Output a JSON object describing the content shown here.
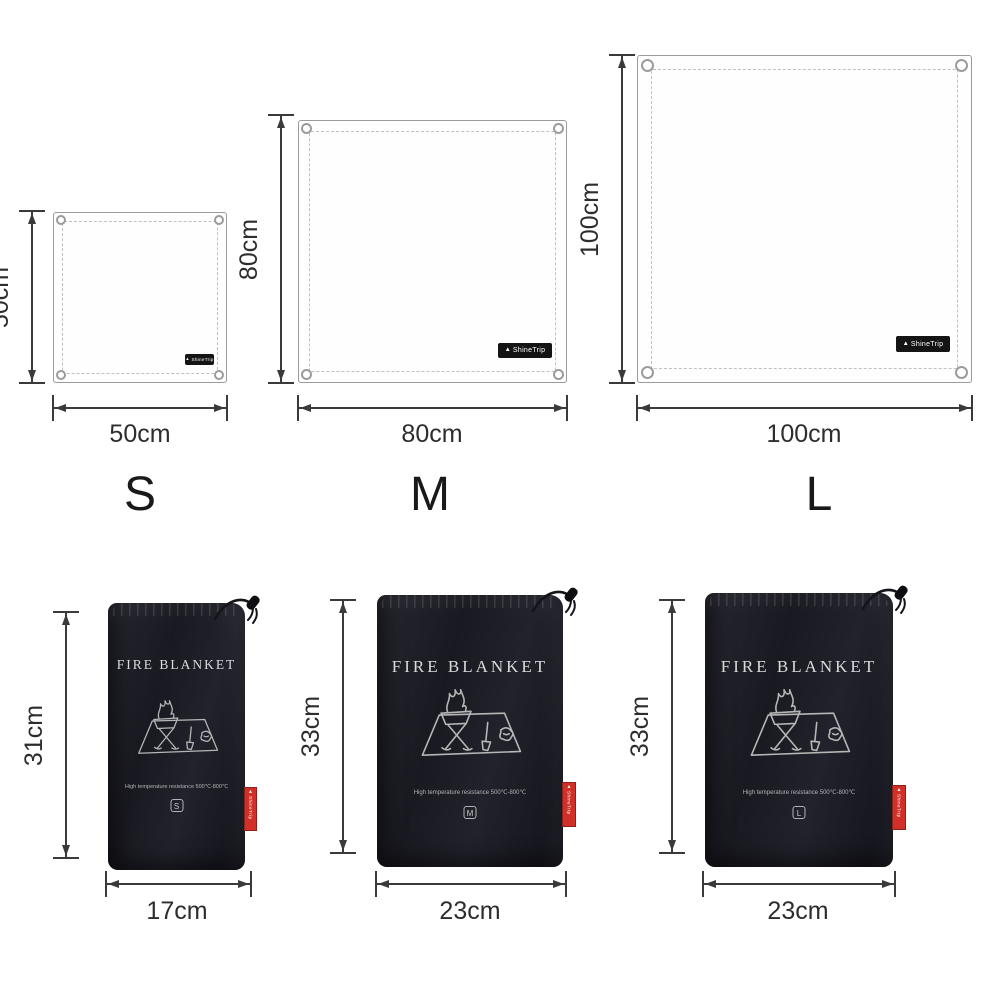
{
  "background_color": "#ffffff",
  "colors": {
    "dimension_lines": "#3a3a3a",
    "blanket_outline": "#9b9b9b",
    "bag_fabric": "#1a1a22",
    "brand_label_bg": "#141414",
    "red_tag": "#d03028"
  },
  "brand": {
    "name": "ShineTrip"
  },
  "blankets": [
    {
      "size_letter": "S",
      "height_label": "50cm",
      "width_label": "50cm"
    },
    {
      "size_letter": "M",
      "height_label": "80cm",
      "width_label": "80cm"
    },
    {
      "size_letter": "L",
      "height_label": "100cm",
      "width_label": "100cm"
    }
  ],
  "bags": [
    {
      "title": "FIRE BLANKET",
      "subtitle": "High temperature resistance   500℃-800℃",
      "size_letter": "S",
      "height_label": "31cm",
      "width_label": "17cm"
    },
    {
      "title": "FIRE BLANKET",
      "subtitle": "High temperature resistance   500℃-800℃",
      "size_letter": "M",
      "height_label": "33cm",
      "width_label": "23cm"
    },
    {
      "title": "FIRE BLANKET",
      "subtitle": "High temperature resistance   500℃-800℃",
      "size_letter": "L",
      "height_label": "33cm",
      "width_label": "23cm"
    }
  ],
  "icons": {
    "brand_logo": "mountain-icon",
    "drawstring": "cord-toggle-icon",
    "bag_graphic": "campfire-stove-mat-illustration"
  }
}
